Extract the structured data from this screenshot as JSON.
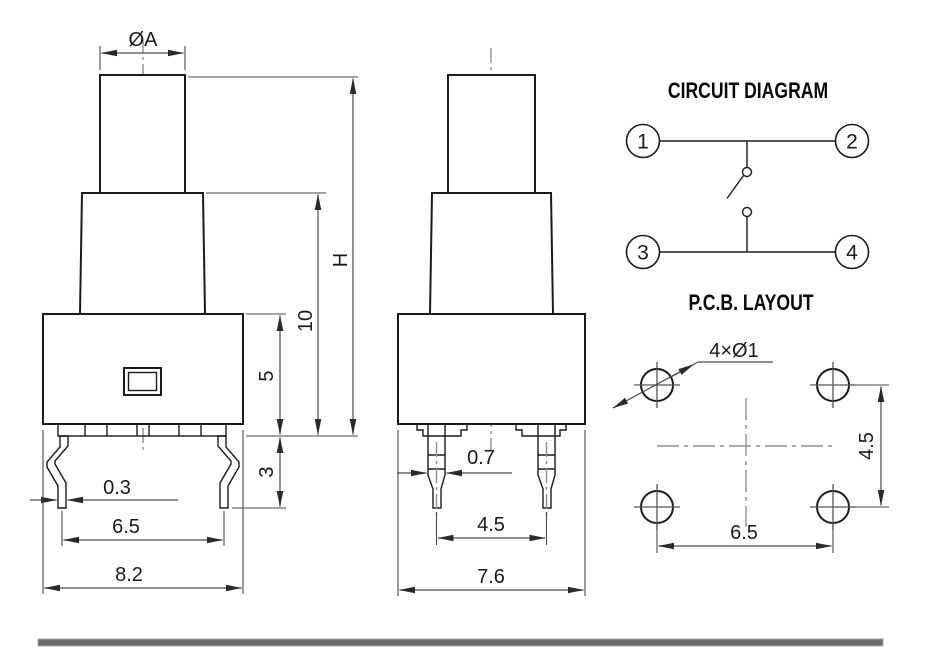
{
  "front_view": {
    "dims": {
      "plunger_diameter": "ØA",
      "total_height": "H",
      "upper_height": "10",
      "body_height": "5",
      "leg_length": "3",
      "leg_thickness": "0.3",
      "leg_spacing": "6.5",
      "body_width": "8.2"
    }
  },
  "side_view": {
    "dims": {
      "pin_width": "0.7",
      "pin_spacing": "4.5",
      "body_depth": "7.6"
    }
  },
  "circuit_diagram": {
    "title": "CIRCUIT DIAGRAM",
    "terminals": [
      "1",
      "2",
      "3",
      "4"
    ]
  },
  "pcb_layout": {
    "title": "P.C.B. LAYOUT",
    "hole_callout": "4×Ø1",
    "hole_spacing_vertical": "4.5",
    "hole_spacing_horizontal": "6.5"
  }
}
